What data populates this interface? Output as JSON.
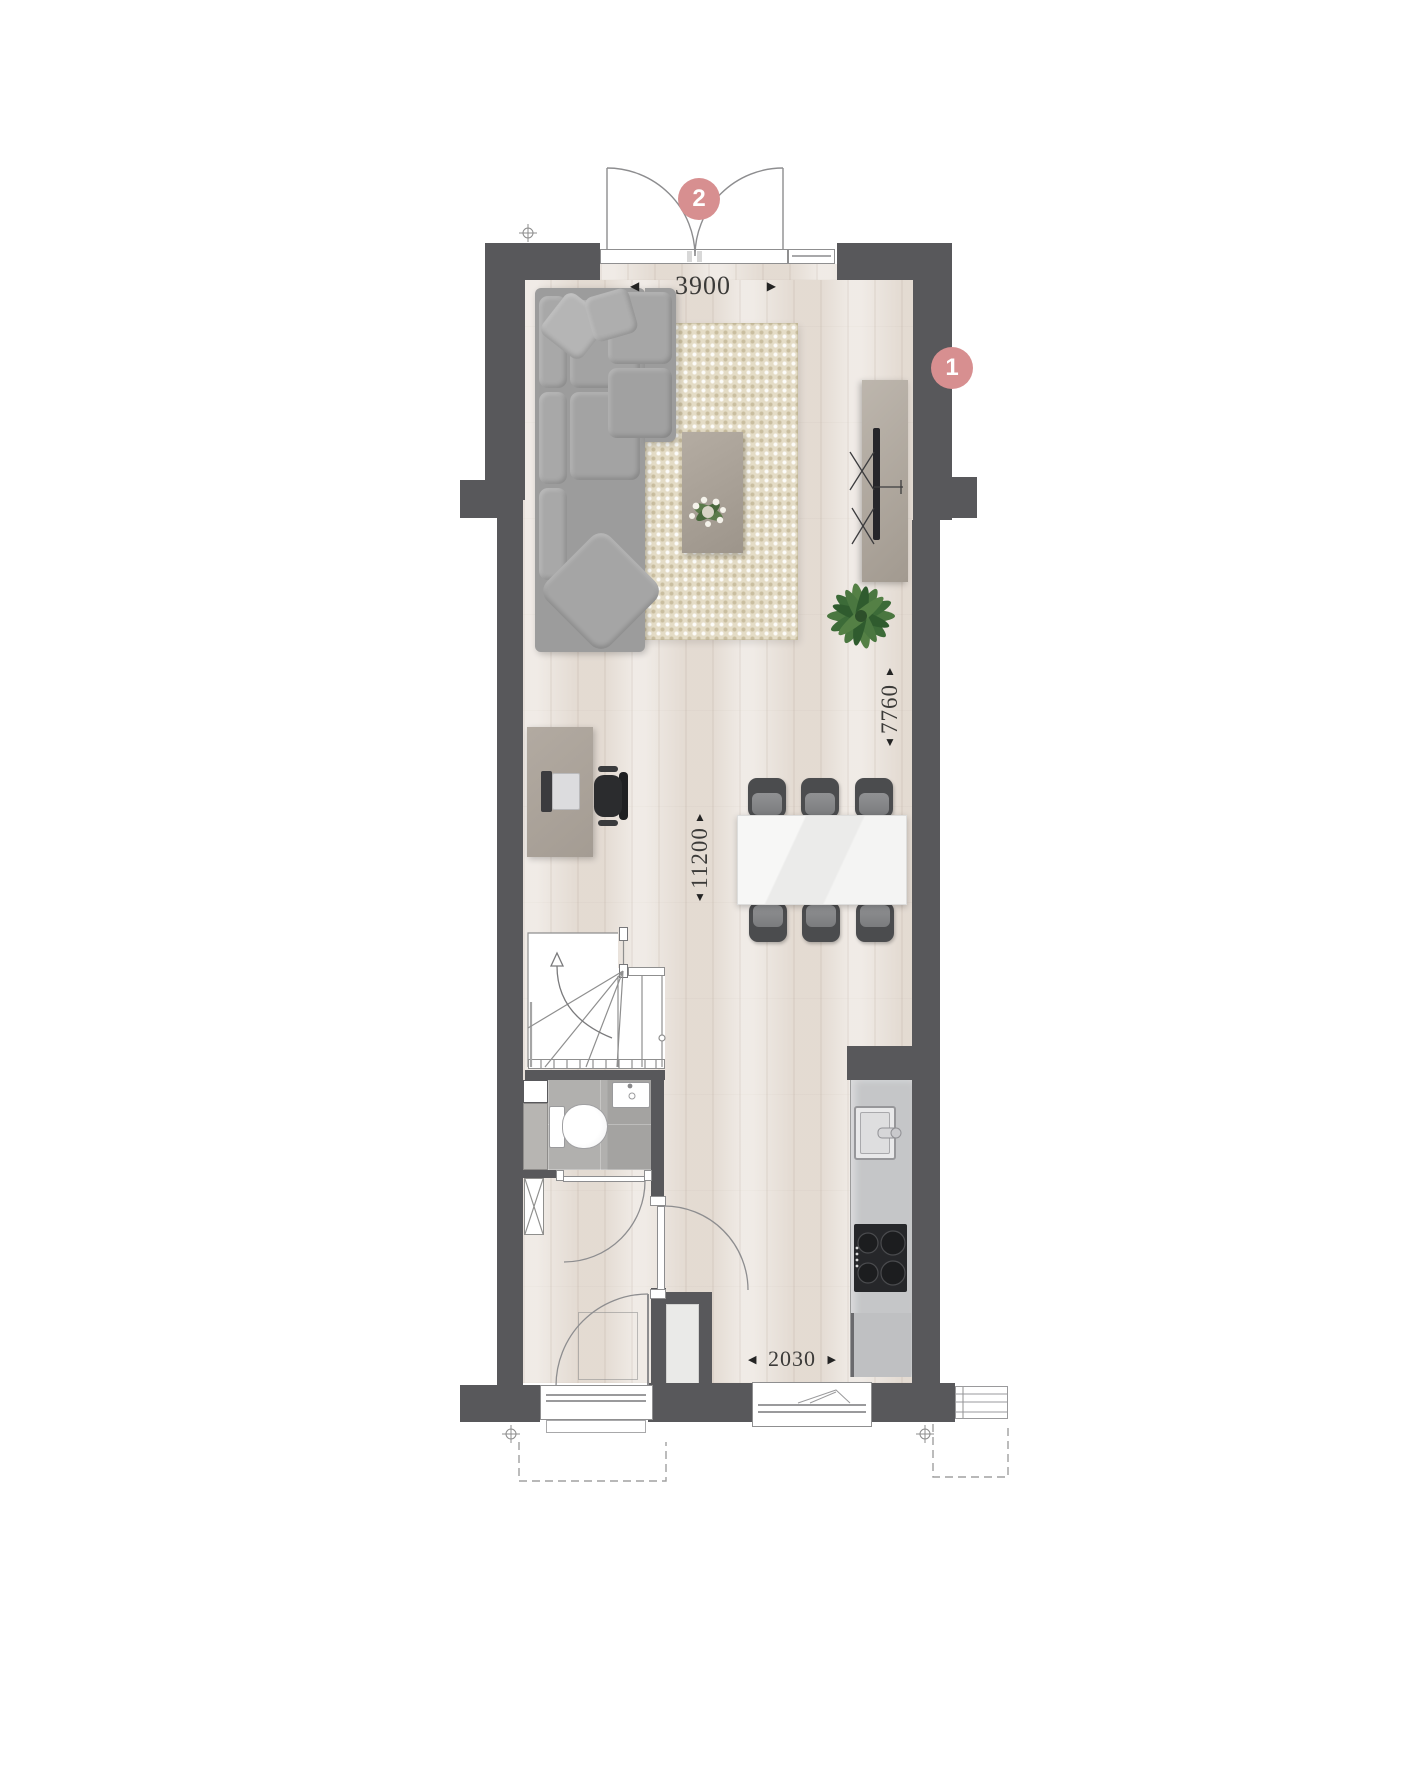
{
  "plan": {
    "markers": {
      "rear_doors": {
        "label": "2"
      },
      "side_wall": {
        "label": "1"
      }
    },
    "dimensions": {
      "top": {
        "value": "3900",
        "arrow_left": "◀",
        "arrow_right": "▶"
      },
      "right": {
        "value": "7760",
        "arrow_up": "▲",
        "arrow_down": "▼"
      },
      "middle": {
        "value": "11200",
        "arrow_up": "▲",
        "arrow_down": "▼"
      },
      "bottom": {
        "value": "2030",
        "arrow_left": "◀",
        "arrow_right": "▶"
      }
    },
    "colors": {
      "wall": "#58585b",
      "floor": "#e9e2db",
      "rug": "#e4dcc6",
      "marker": "#d78f90",
      "tile": "#adacaa",
      "kitchen_counter": "#c5c6c8",
      "dimension_text": "#3b3a38"
    }
  }
}
